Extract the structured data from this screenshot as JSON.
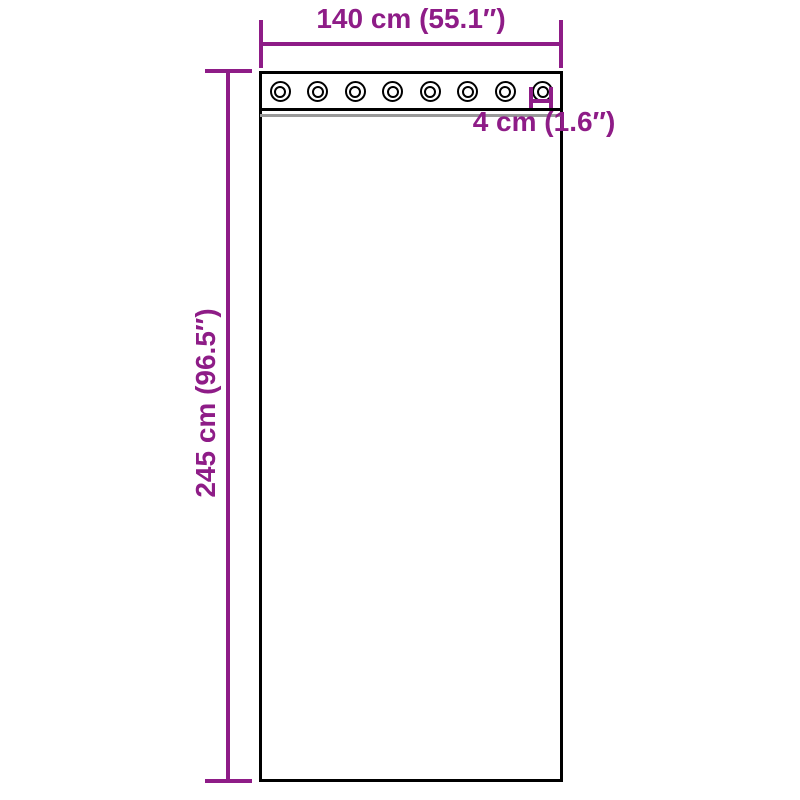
{
  "diagram": {
    "product": "grommet-curtain-dimension-diagram",
    "width_label": "140 cm (55.1″)",
    "height_label": "245 cm (96.5″)",
    "grommet_label": "4 cm (1.6″)",
    "grommet_count": 8,
    "colors": {
      "dimension": "#8E1C87",
      "outline": "#000000",
      "fold_line": "#999999",
      "background": "#FFFFFF"
    }
  }
}
